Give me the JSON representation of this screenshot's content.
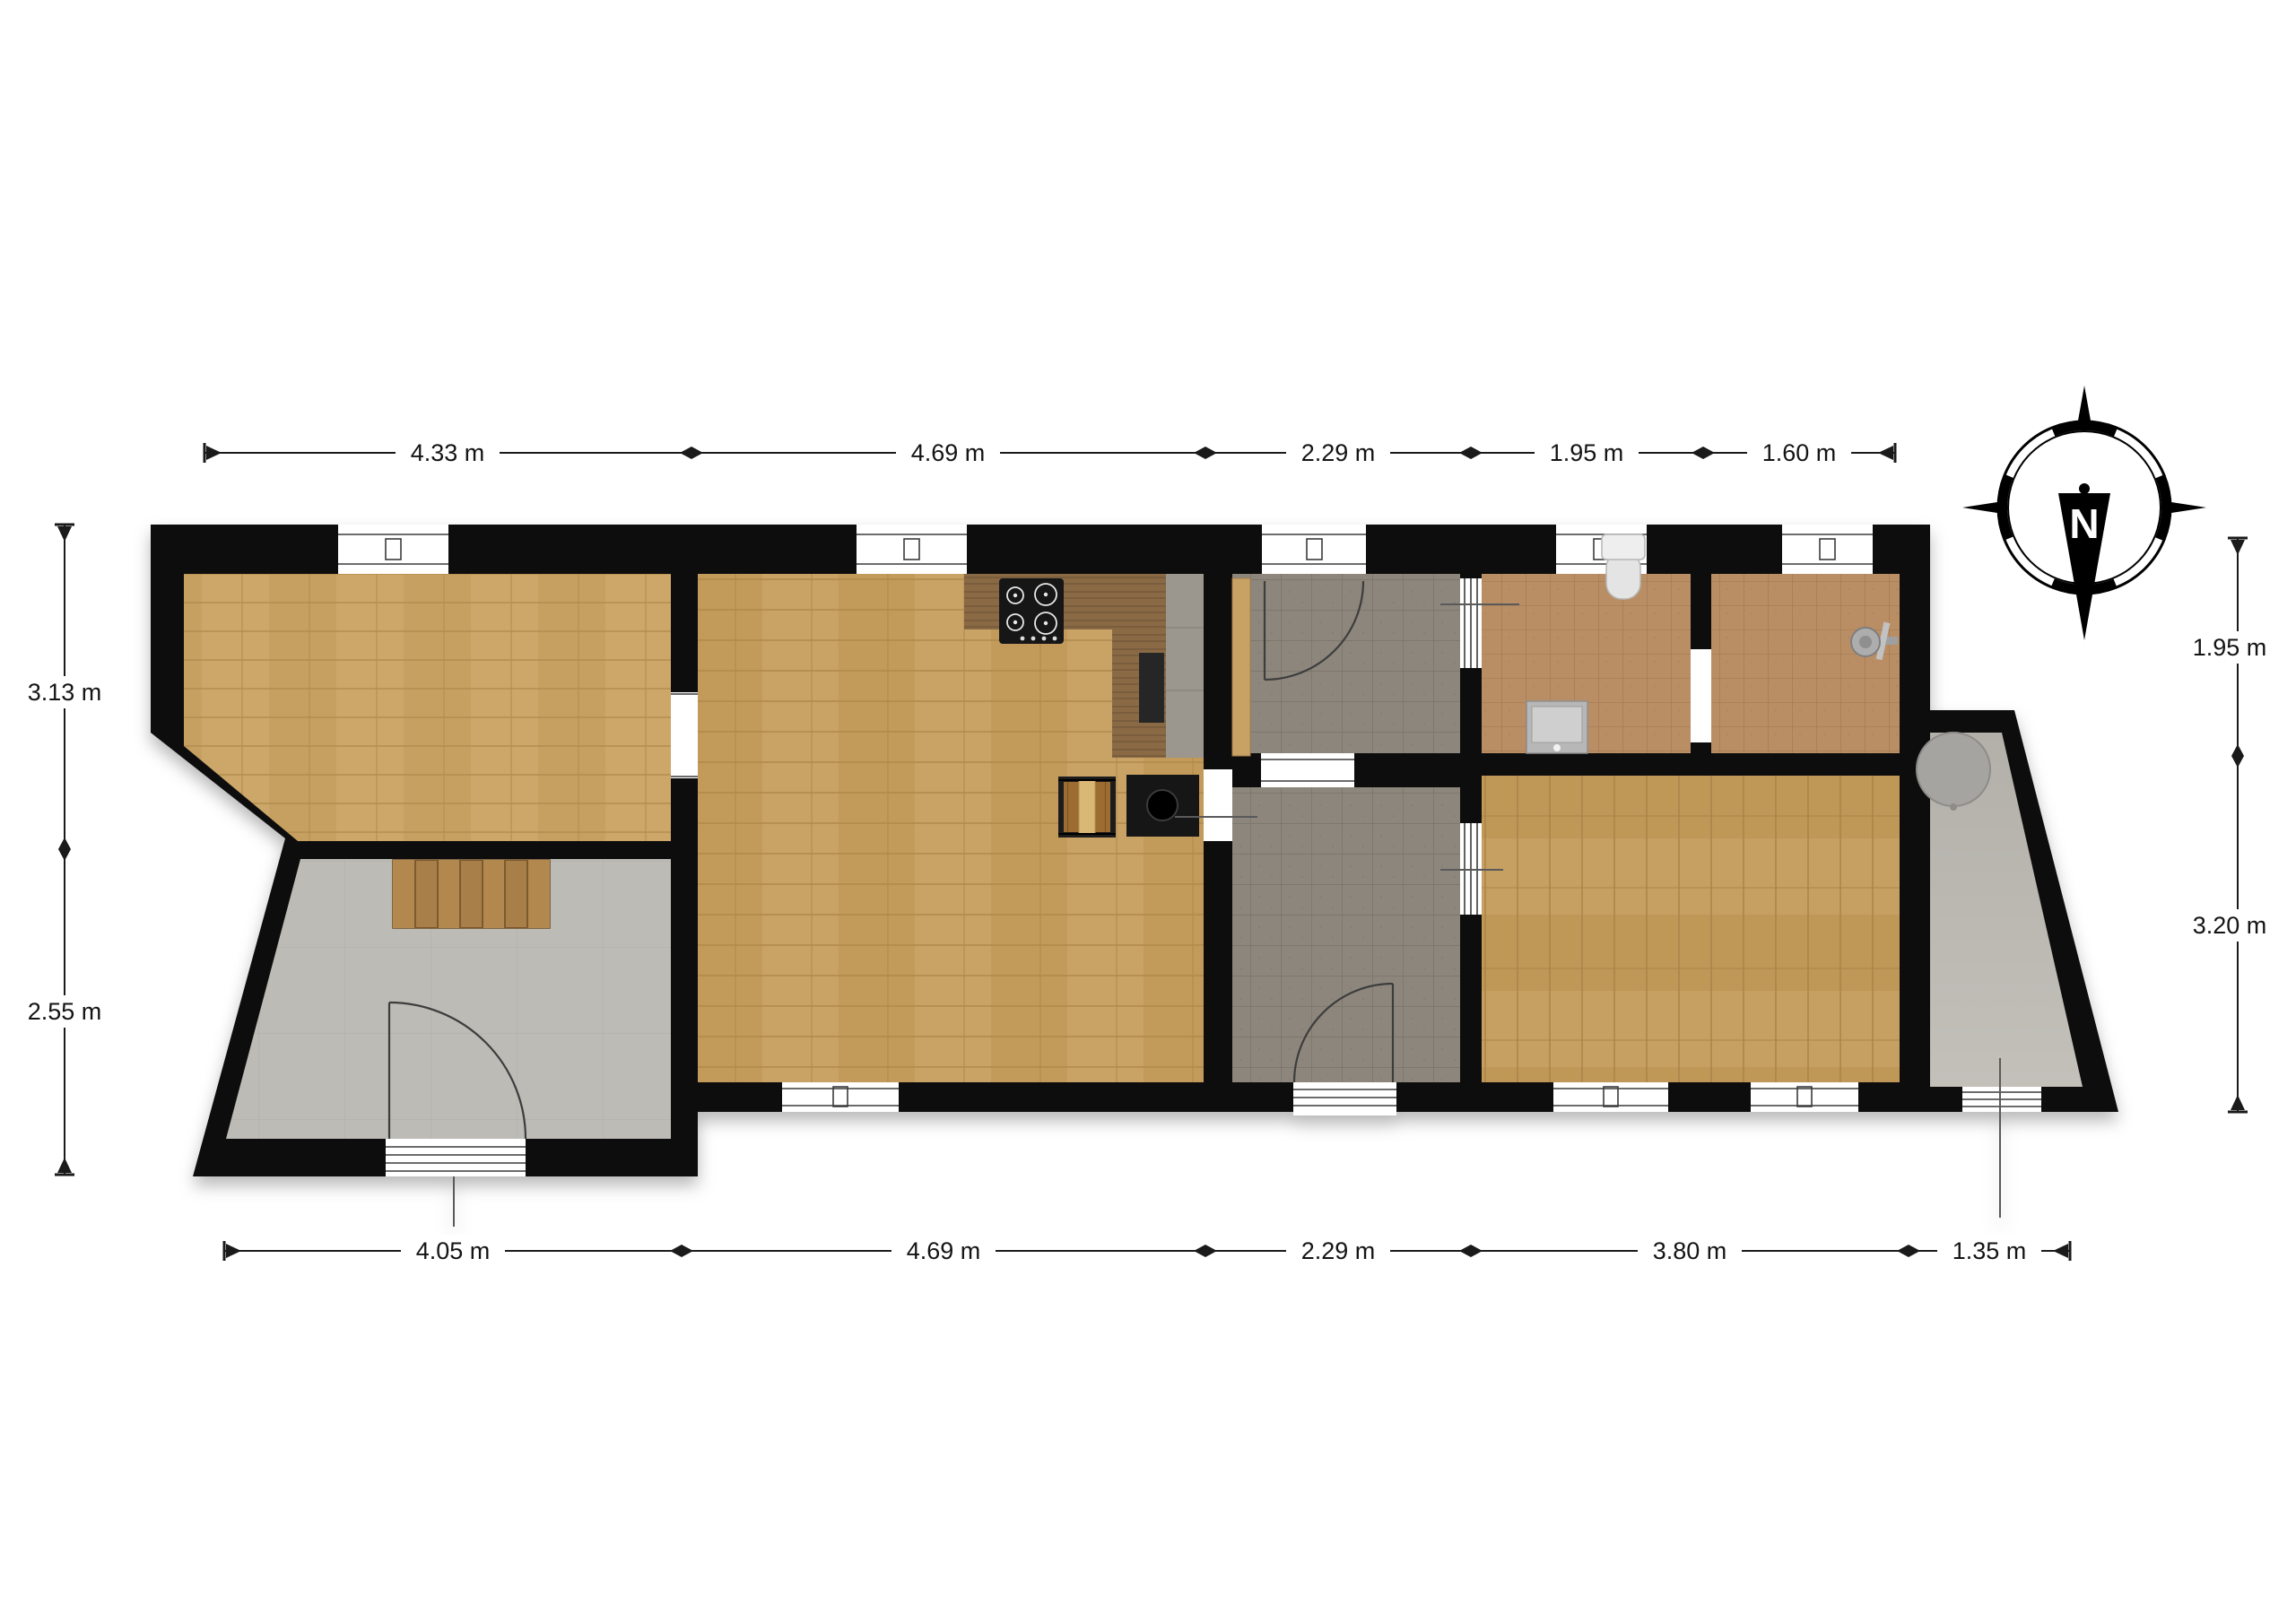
{
  "dimensions": {
    "top": [
      "4.33 m",
      "4.69 m",
      "2.29 m",
      "1.95 m",
      "1.60 m"
    ],
    "bottom": [
      "4.05 m",
      "4.69 m",
      "2.29 m",
      "3.80 m",
      "1.35 m"
    ],
    "left": [
      "3.13 m",
      "2.55 m"
    ],
    "right": [
      "1.95 m",
      "3.20 m"
    ]
  },
  "compass": {
    "label": "N"
  },
  "colors": {
    "wall": "#0c0c0c",
    "wood_bedroom_left": "#cda76a",
    "wood_living": "#c9a365",
    "wood_bedroom_right": "#c6a062",
    "tile_gray": "#8d867c",
    "tile_terracotta": "#ba8e65",
    "concrete_hall": "#bdbbb6",
    "annex_floor": "#b8b5af",
    "counter_wood": "#8a6a45",
    "stairs": "#a97f49"
  },
  "fixtures": {
    "stove": "gas-hob-icon",
    "kitchen_sink": "kitchen-sink-icon",
    "island": "kitchen-island-icon",
    "log_basket": "log-basket-icon",
    "stairs": "staircase-icon",
    "toilet": "toilet-icon",
    "washbasin": "washbasin-icon",
    "shower": "shower-head-icon",
    "boiler": "boiler-tank-icon",
    "compass": "compass-rose-icon"
  }
}
